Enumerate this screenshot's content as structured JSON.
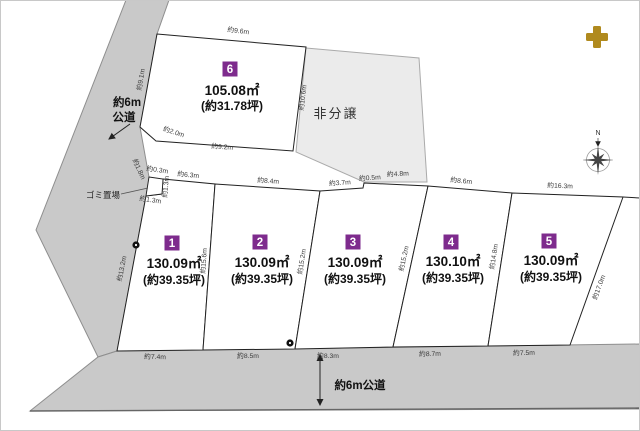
{
  "title": "土地区画図",
  "colors": {
    "road": "#c9c9c9",
    "not_for_sale_fill": "#ebebeb",
    "lot_highlight": "#eac8a0",
    "lot_fill": "#ffffff",
    "badge": "#7e2b8d",
    "plus_icon": "#b08a1e"
  },
  "roads": {
    "left": {
      "line1": "約6m",
      "line2": "公道"
    },
    "bottom": {
      "label": "約6m公道"
    }
  },
  "not_for_sale": {
    "label": "非分譲"
  },
  "garbage": {
    "label": "ゴミ置場"
  },
  "compass": {
    "north": "N"
  },
  "lots": [
    {
      "no": "1",
      "area": "130.09㎡",
      "tsubo": "(約39.35坪)",
      "highlight": false
    },
    {
      "no": "2",
      "area": "130.09㎡",
      "tsubo": "(約39.35坪)",
      "highlight": false
    },
    {
      "no": "3",
      "area": "130.09㎡",
      "tsubo": "(約39.35坪)",
      "highlight": true
    },
    {
      "no": "4",
      "area": "130.10㎡",
      "tsubo": "(約39.35坪)",
      "highlight": false
    },
    {
      "no": "5",
      "area": "130.09㎡",
      "tsubo": "(約39.35坪)",
      "highlight": false
    },
    {
      "no": "6",
      "area": "105.08㎡",
      "tsubo": "(約31.78坪)",
      "highlight": false
    }
  ],
  "dims": {
    "lot6_top": "約9.6m",
    "lot6_left": "約9.1m",
    "lot6_right": "約10.6m",
    "lot6_bottom": "約9.2m",
    "lot6_corner": "約2.0m",
    "gomi_top": "約0.3m",
    "gomi_slant": "約1.8m",
    "gomi_side": "約1.3m",
    "gomi_bottom": "約1.3m",
    "lot1_top": "約6.3m",
    "lot2_top": "約8.4m",
    "lot3_top_a": "約3.7m",
    "lot3_step": "約0.5m",
    "lot3_top_b": "約4.8m",
    "lot4_top": "約8.6m",
    "lot5_top": "約16.3m",
    "lot1_west": "約13.2m",
    "b12": "約15.6m",
    "b23": "約15.2m",
    "b34": "約15.2m",
    "b45": "約14.8m",
    "lot5_east": "約17.0m",
    "lot1_bottom": "約7.4m",
    "lot2_bottom": "約8.5m",
    "lot3_bottom": "約8.3m",
    "lot4_bottom": "約8.7m",
    "lot5_bottom": "約7.5m"
  }
}
